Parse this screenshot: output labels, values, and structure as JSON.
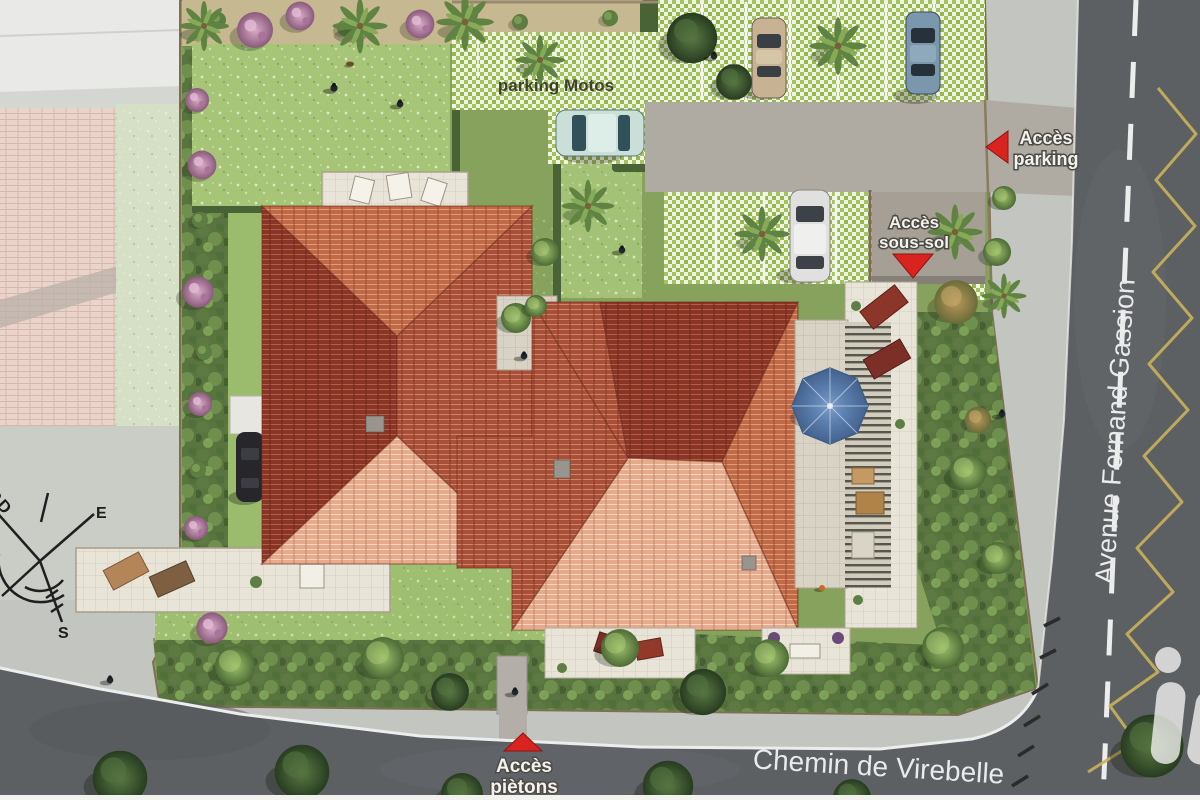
{
  "labels": {
    "parking_motos": "parking Motos"
  },
  "access": {
    "parking": {
      "line1": "Accès",
      "line2": "parking",
      "marker": "red-arrow-left"
    },
    "sous_sol": {
      "line1": "Accès",
      "line2": "sous-sol",
      "marker": "red-triangle-down"
    },
    "pietons": {
      "line1": "Accès",
      "line2": "piètons",
      "marker": "red-triangle-up"
    }
  },
  "roads": {
    "avenue": "Avenue Fernand Gassion",
    "chemin": "Chemin de Virebelle"
  },
  "compass": {
    "north": "NORD",
    "east": "E",
    "south": "S"
  },
  "watermark": {
    "letter": "i"
  },
  "colors": {
    "marker_red": "#d8231f",
    "zigzag_yellow": "#c9b359",
    "parasol_blue": "#5b7fae",
    "roof_dark": "#8a3526",
    "roof_mid": "#bc6242",
    "roof_light": "#e4a888",
    "lawn_green": "#a6c577",
    "paver_green": "#a3c35c",
    "road_gray": "#5c6063",
    "sidewalk_gray": "#c2c5c0",
    "deck_beige": "#e7e3d6"
  }
}
